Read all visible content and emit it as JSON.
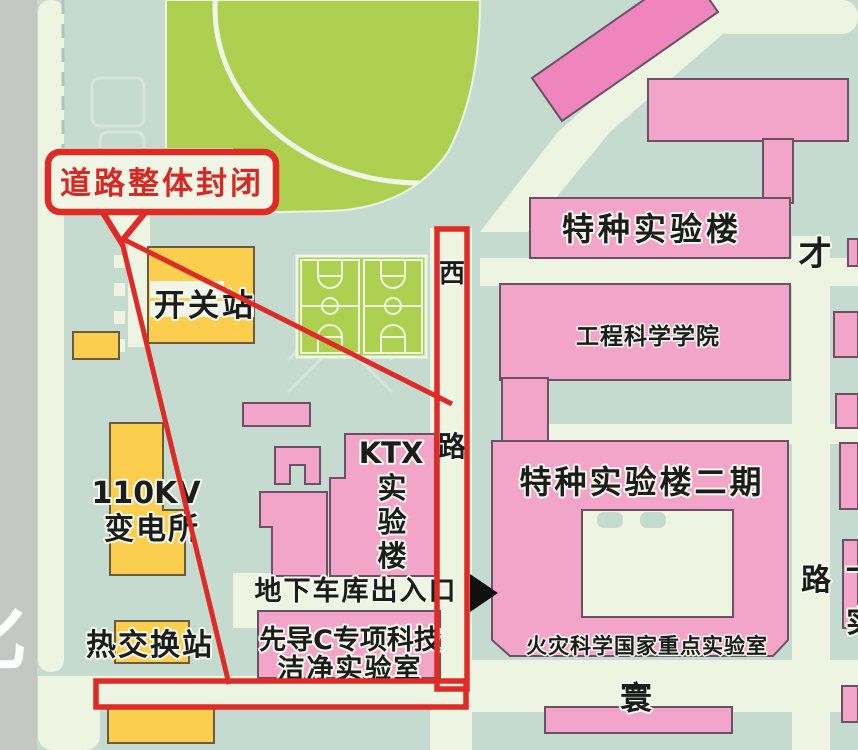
{
  "colors": {
    "background_teal": "#c6dbd0",
    "road_cream": "#edf4e1",
    "road_grey": "#c5c7c3",
    "field_green": "#aed050",
    "building_pink": "#f3a5c9",
    "building_pink_dark": "#ee86bd",
    "building_yellow": "#fbce4d",
    "building_outline": "#6a5264",
    "closure_red": "#df2b26",
    "label_text": "#1c1c1c"
  },
  "callout": {
    "text": "道路整体封闭"
  },
  "buildings": {
    "special_lab": "特种实验楼",
    "engineering_school": "工程科学学院",
    "special_lab_phase2": "特种实验楼二期",
    "fire_lab": "火灾科学国家重点实验室",
    "ktx": {
      "l1": "KTX",
      "l2": "实",
      "l3": "验",
      "l4": "楼"
    },
    "pilot_c": {
      "l1": "先导C专项科技",
      "l2": "洁净实验室"
    },
    "switch_station": "开关站",
    "substation": {
      "l1": "110KV",
      "l2": "变电所"
    },
    "heat_exchange_station": "热交换站"
  },
  "roads": {
    "west_road": {
      "c1": "西",
      "c2": "路"
    },
    "cai": "才",
    "huan": "寰",
    "right_edge": {
      "road_char": "路",
      "partial_stroke": "一",
      "partial_shi": "实"
    },
    "left_edge_partial": "化"
  },
  "poi": {
    "garage_exit": "地下车库出入口"
  }
}
